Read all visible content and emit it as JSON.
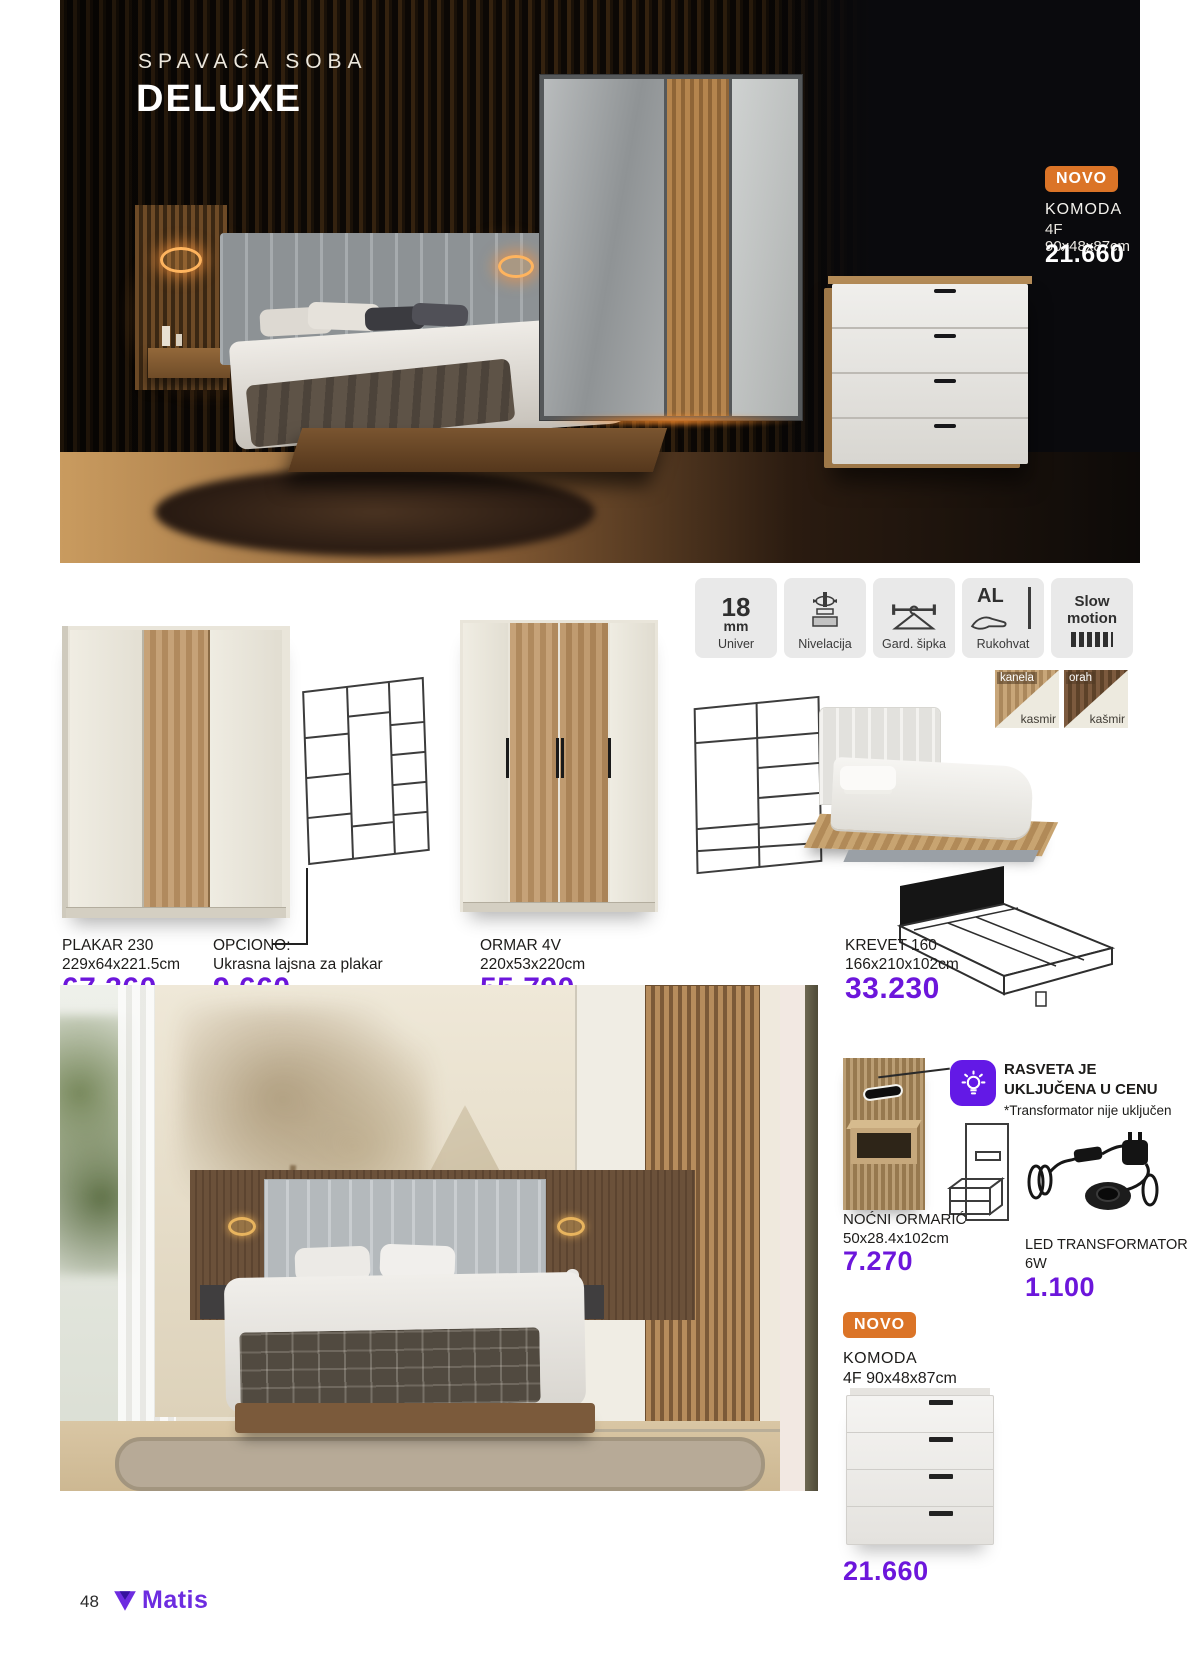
{
  "colors": {
    "accent_purple": "#6c16db",
    "badge_orange": "#db7427",
    "logo_purple": "#6d2ce0"
  },
  "hero": {
    "subtitle": "SPAVAĆA SOBA",
    "title": "DELUXE",
    "badge": "NOVO",
    "product": {
      "name": "KOMODA",
      "dims": "4F 90x48x87cm",
      "price": "21.660"
    }
  },
  "features": {
    "univer": {
      "big": "18",
      "unit": "mm",
      "label": "Univer"
    },
    "nivelacija": {
      "label": "Nivelacija"
    },
    "sipka": {
      "label": "Gard. šipka"
    },
    "rukohvat": {
      "al": "AL",
      "label": "Rukohvat"
    },
    "slow": {
      "line1": "Slow",
      "line2": "motion"
    }
  },
  "swatches": {
    "s1": {
      "top": "kanela",
      "bottom": "kasmir"
    },
    "s2": {
      "top": "orah",
      "bottom": "kašmir"
    }
  },
  "products": {
    "plakar": {
      "name": "PLAKAR 230",
      "dims": "229x64x221.5cm",
      "price": "67.360"
    },
    "opciono": {
      "name": "OPCIONO:",
      "desc": "Ukrasna lajsna za plakar",
      "price": "9.660"
    },
    "ormar": {
      "name": "ORMAR 4V",
      "dims": "220x53x220cm",
      "price": "55.790"
    },
    "krevet": {
      "name": "KREVET 160",
      "dims": "166x210x102cm",
      "price": "33.230"
    }
  },
  "bottom": {
    "nocni": {
      "name": "NOĆNI ORMARIĆ",
      "dims": "50x28.4x102cm",
      "price": "7.270"
    },
    "rasveta": {
      "line1": "RASVETA JE",
      "line2": "UKLJUČENA U CENU",
      "note": "*Transformator nije uključen"
    },
    "led": {
      "name": "LED TRANSFORMATOR",
      "dims": "6W",
      "price": "1.100"
    },
    "komoda": {
      "badge": "NOVO",
      "name": "KOMODA",
      "dims": "4F 90x48x87cm",
      "price": "21.660"
    }
  },
  "footer": {
    "page": "48",
    "brand": "Matis"
  }
}
